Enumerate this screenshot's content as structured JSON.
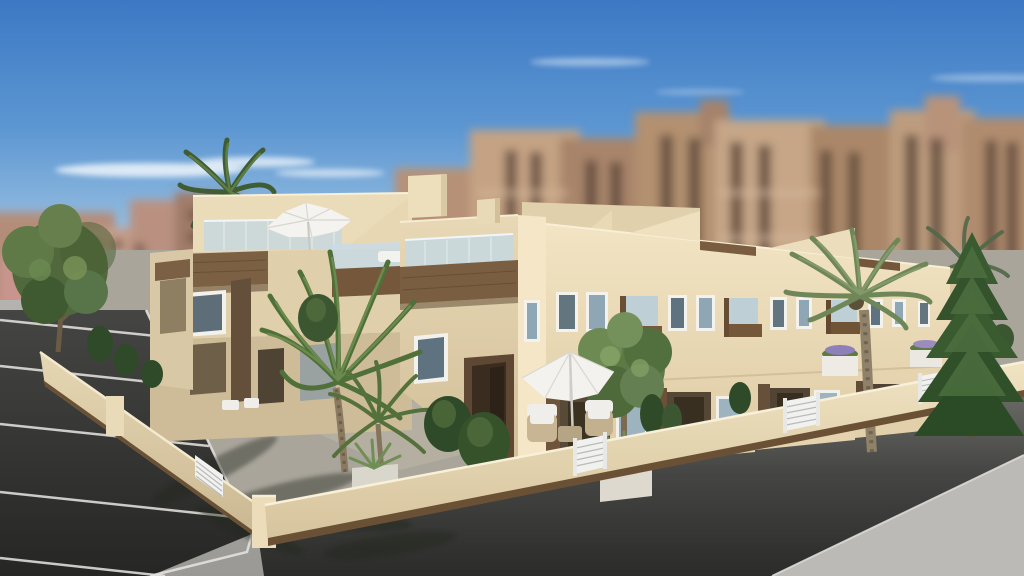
{
  "scene": {
    "title": "3D architectural render of a modern cream townhouse complex on a street corner",
    "type": "exterior-architectural-rendering",
    "sky": "clear blue sky fading to pale haze at the horizon with thin wispy white clouds",
    "background": "out-of-focus tan and brown high-rise apartment blocks with dark window strips",
    "building": {
      "style": "two-storey Mediterranean townhouse row seen from a street corner",
      "wall_color_name": "cream",
      "accents": "dark wood fascia bands, wood-clad balcony boxes and entrance portals",
      "features": [
        "stepped and sloped roof parapets",
        "roof terraces with glass balustrades and white lounge furniture",
        "white parasol on roof terrace",
        "white-framed windows",
        "small wood-and-glass balconies",
        "recessed ground-floor porches",
        "private patios with low cream walls and white planter boxes"
      ]
    },
    "foreground": [
      "dark asphalt road with white parking bay lines on the left",
      "dark asphalt street along the front",
      "light grey pavements and kerbs",
      "cream perimeter wall with dark timber base strip and white louvred gates",
      "palm tree shadows on the pavement"
    ],
    "vegetation": [
      "tall palm trees in the garden",
      "palm crown rising behind the left roof",
      "round leafy trees",
      "dark conifer shrubs and agaves in planters",
      "large conifer tree at the right"
    ],
    "furniture": [
      "white patio parasol with two wicker armchairs and a low table",
      "white lounge seats on the roof terrace"
    ],
    "palette": {
      "sky_top": "#3c78c4",
      "sky_horizon": "#d7e5f0",
      "wall_cream": "#ecdcba",
      "wall_shadow": "#cdbb96",
      "wood_brown": "#775b3f",
      "portal_brown": "#4a3826",
      "glass_blue": "#c6d8e1",
      "window_glass": "#5f7280",
      "road_dark": "#2e2e2c",
      "pavement_grey": "#b1b0ac",
      "foliage_green": "#4e6a3a",
      "background_buildings": "#b9957c",
      "gate_white": "#f1f2f0"
    }
  }
}
